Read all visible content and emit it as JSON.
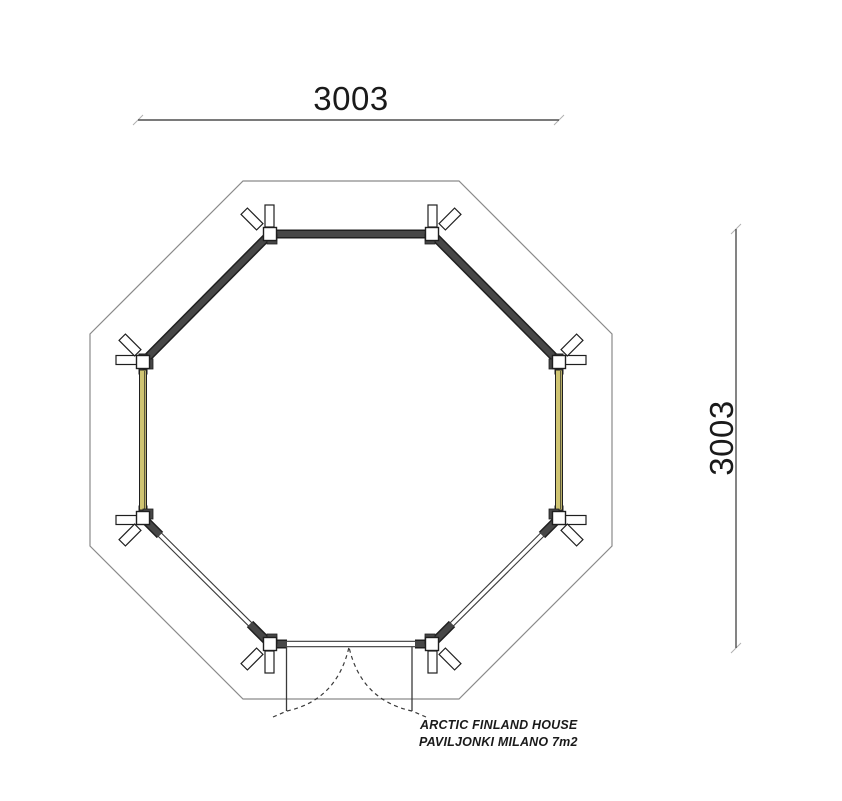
{
  "dimensions": {
    "top": {
      "value": "3003"
    },
    "right": {
      "value": "3003"
    }
  },
  "label": {
    "line1": "ARCTIC FINLAND HOUSE",
    "line2": "PAVILJONKI MILANO 7m2"
  },
  "colors": {
    "wall_dark": "#474747",
    "wall_edge": "#1f1f1f",
    "glazing_yellow": "#cfc472",
    "thin_line": "#3a3a3a",
    "roof_line": "#8a8a8a",
    "dim_line": "#4f4f4f",
    "text_color": "#1a1a1a",
    "bg": "#ffffff"
  }
}
